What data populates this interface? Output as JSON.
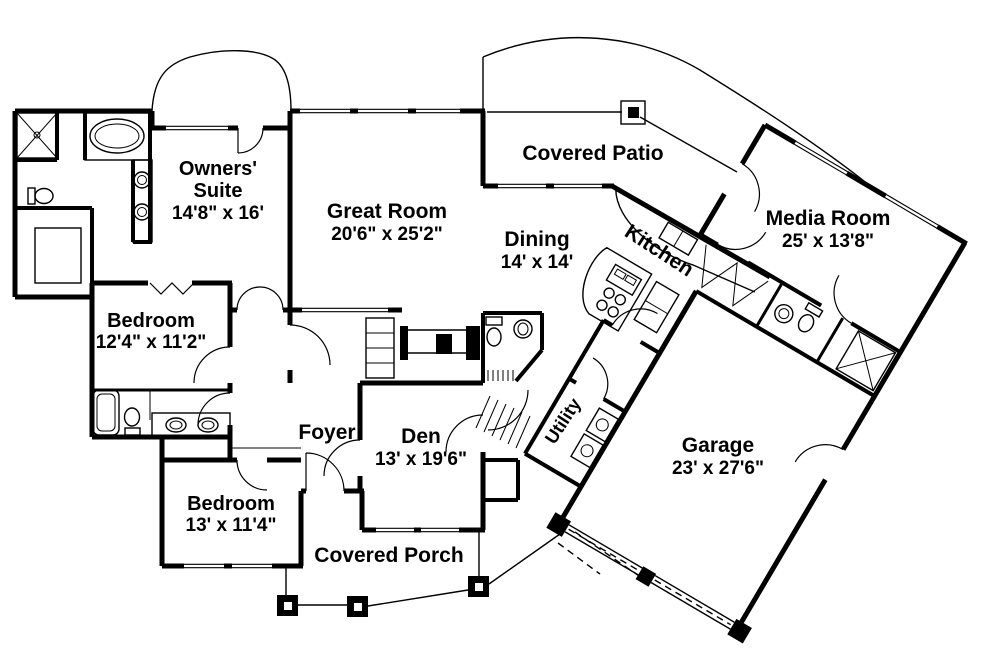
{
  "rooms": {
    "owners_suite": {
      "line1": "Owners'",
      "line2": "Suite",
      "dims": "14'8\" x 16'"
    },
    "great_room": {
      "name": "Great Room",
      "dims": "20'6\" x 25'2\""
    },
    "covered_patio": {
      "name": "Covered Patio"
    },
    "media_room": {
      "name": "Media Room",
      "dims": "25' x 13'8\""
    },
    "dining": {
      "name": "Dining",
      "dims": "14' x 14'"
    },
    "kitchen": {
      "name": "Kitchen"
    },
    "bedroom_upper": {
      "name": "Bedroom",
      "dims": "12'4\" x 11'2\""
    },
    "bedroom_lower": {
      "name": "Bedroom",
      "dims": "13' x 11'4\""
    },
    "foyer": {
      "name": "Foyer"
    },
    "den": {
      "name": "Den",
      "dims": "13' x 19'6\""
    },
    "utility": {
      "name": "Utility"
    },
    "garage": {
      "name": "Garage",
      "dims": "23' x 27'6\""
    },
    "covered_porch": {
      "name": "Covered Porch"
    }
  },
  "colors": {
    "ink": "#000000",
    "paper": "#ffffff"
  }
}
